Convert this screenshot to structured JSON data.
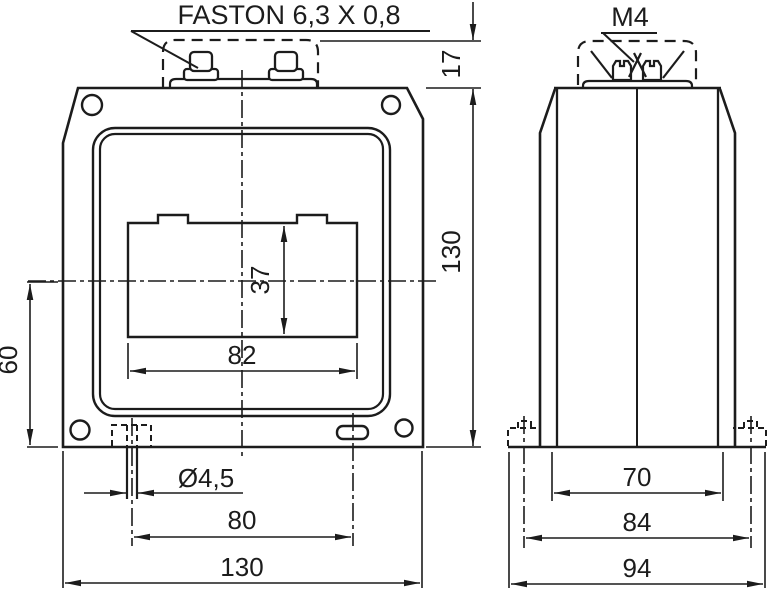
{
  "page": {
    "background": "#ffffff",
    "line_color": "#1c1c1c"
  },
  "labels": {
    "faston": "FASTON 6,3 X 0,8",
    "thread": "M4"
  },
  "front_view": {
    "dimensions": {
      "terminal_height": "17",
      "body_height": "130",
      "window_height": "37",
      "window_width": "82",
      "center_to_bottom": "60",
      "pin_diameter": "Ø4,5",
      "pin_spacing": "80",
      "body_width": "130"
    }
  },
  "side_view": {
    "dimensions": {
      "body_depth": "70",
      "flange_depth": "84",
      "overall_depth": "94"
    }
  }
}
